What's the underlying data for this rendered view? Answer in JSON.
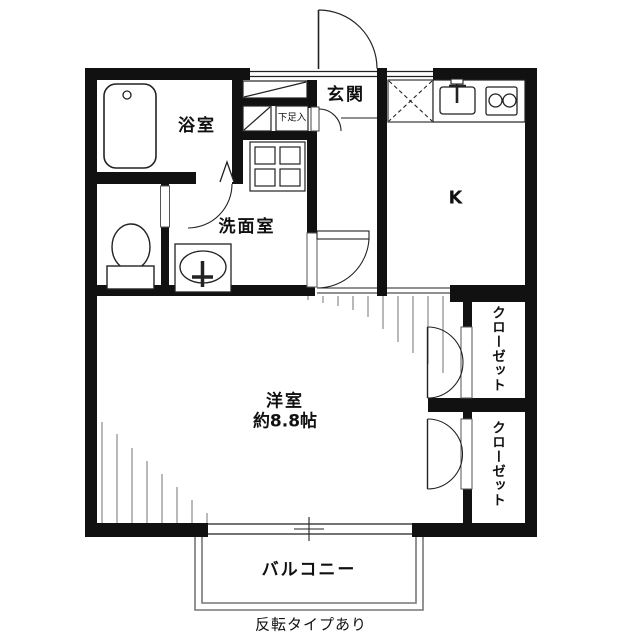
{
  "plan": {
    "entrance_label": "玄関",
    "bath_label": "浴室",
    "washroom_label": "洗面室",
    "shoe_cabinet_label": "下足入",
    "kitchen_label": "K",
    "main_room_label": "洋室",
    "main_room_size": "約8.8帖",
    "closet_upper_label": "クローゼット",
    "closet_lower_label": "クローゼット",
    "balcony_label": "バルコニー",
    "note": "反転タイプあり"
  },
  "colors": {
    "wall": "#111111",
    "line": "#222222",
    "hatch": "#8a8a8a",
    "balcony_border": "#777777",
    "background": "#ffffff"
  }
}
